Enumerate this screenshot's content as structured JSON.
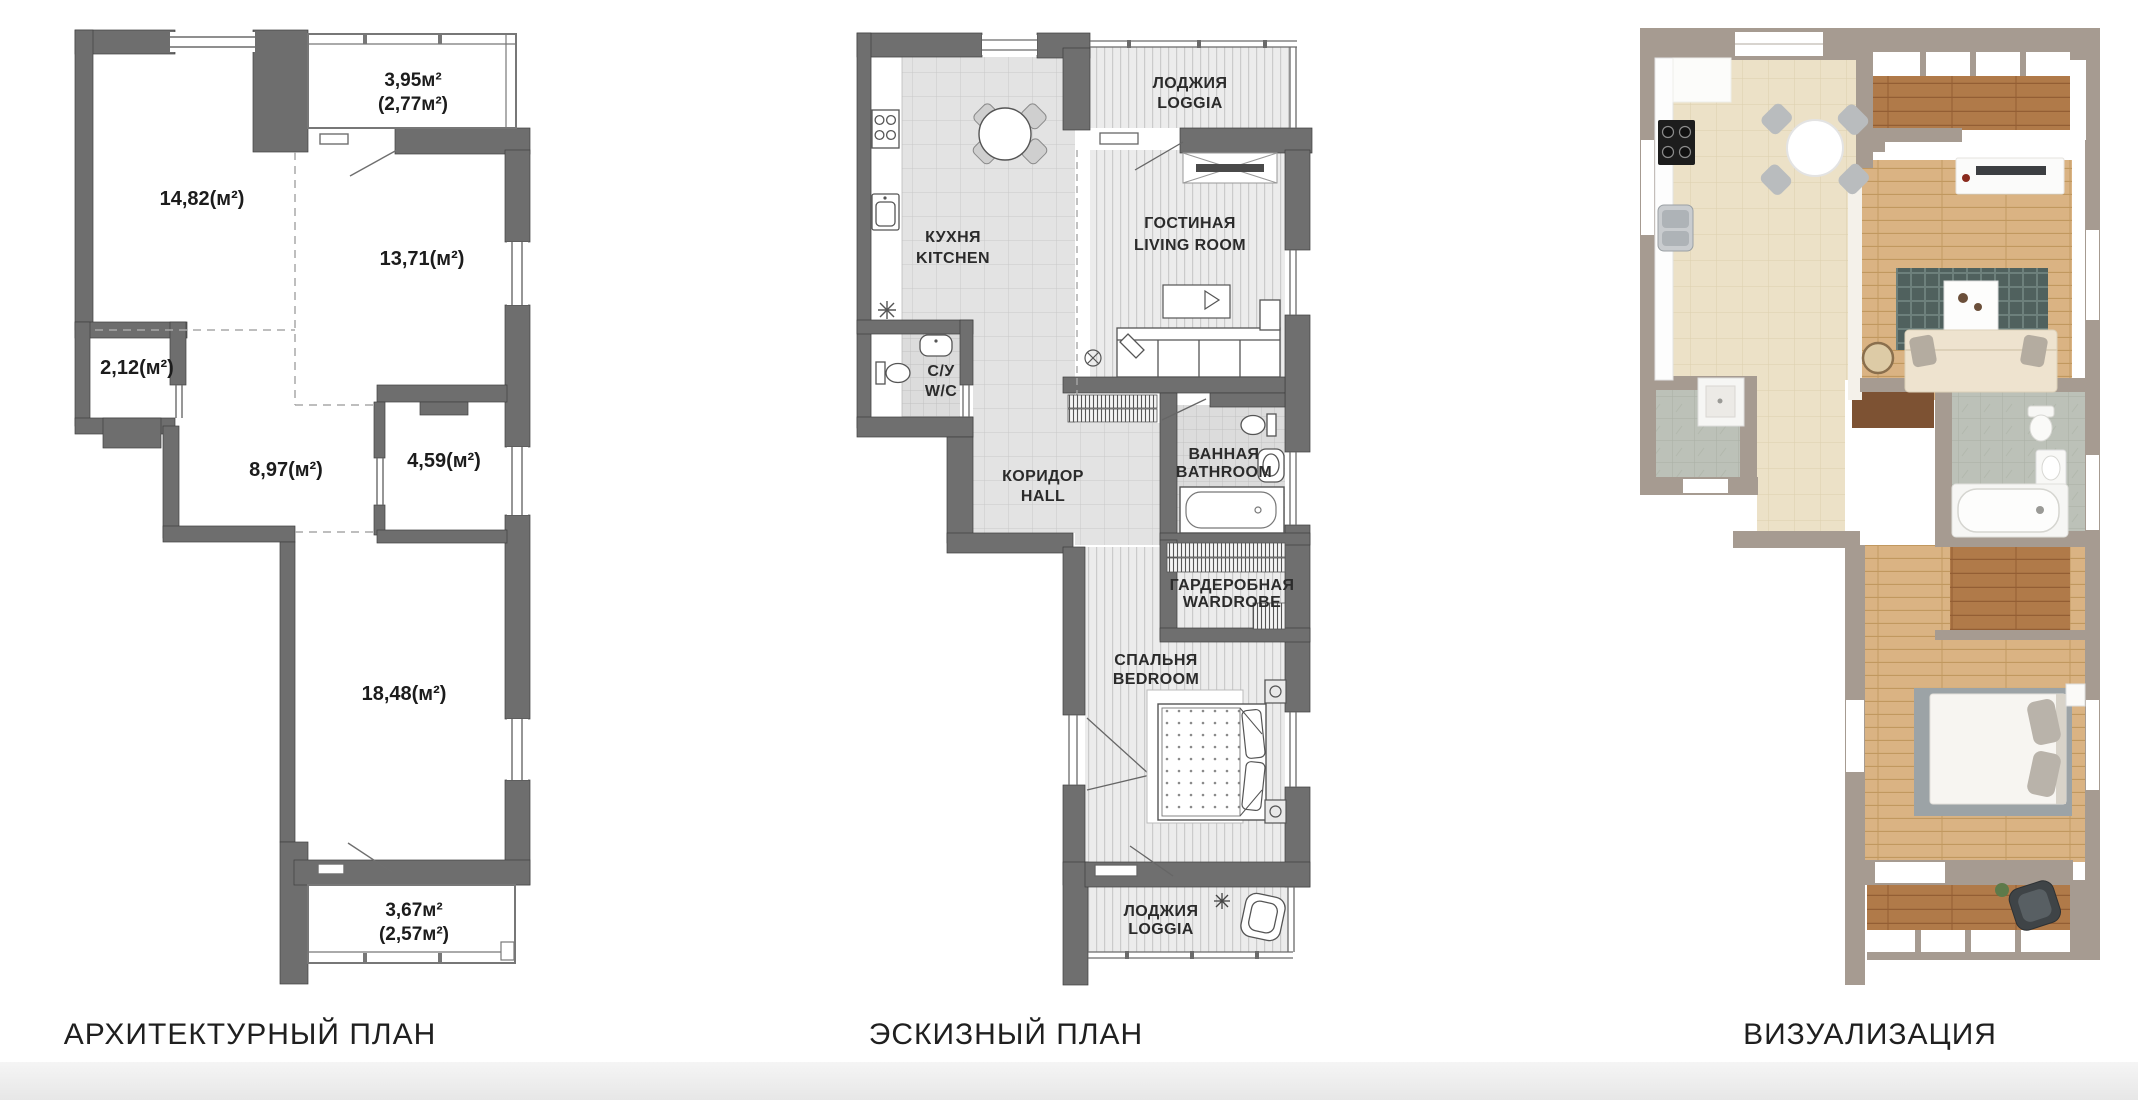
{
  "captions": {
    "architectural": "АРХИТЕКТУРНЫЙ ПЛАН",
    "sketch": "ЭСКИЗНЫЙ ПЛАН",
    "visualization": "ВИЗУАЛИЗАЦИЯ"
  },
  "architectural_plan": {
    "areas": {
      "loggia_top": "3,95м²",
      "loggia_top_alt": "(2,77м²)",
      "room_top_left": "14,82(м²)",
      "room_top_right": "13,71(м²)",
      "niche": "2,12(м²)",
      "hall": "8,97(м²)",
      "bathroom": "4,59(м²)",
      "room_bottom": "18,48(м²)",
      "loggia_bottom": "3,67м²",
      "loggia_bottom_alt": "(2,57м²)"
    }
  },
  "sketch_plan": {
    "rooms": {
      "kitchen": {
        "ru": "КУХНЯ",
        "en": "KITCHEN"
      },
      "loggia_top": {
        "ru": "ЛОДЖИЯ",
        "en": "LOGGIA"
      },
      "living": {
        "ru": "ГОСТИНАЯ",
        "en": "LIVING ROOM"
      },
      "wc": {
        "ru": "С/У",
        "en": "W/C"
      },
      "hall": {
        "ru": "КОРИДОР",
        "en": "HALL"
      },
      "bathroom": {
        "ru": "ВАННАЯ",
        "en": "BATHROOM"
      },
      "wardrobe": {
        "ru": "ГАРДЕРОБНАЯ",
        "en": "WARDROBE"
      },
      "bedroom": {
        "ru": "СПАЛЬНЯ",
        "en": "BEDROOM"
      },
      "loggia_bottom": {
        "ru": "ЛОДЖИЯ",
        "en": "LOGGIA"
      }
    }
  },
  "colors": {
    "plan_wall": "#6e6e6e",
    "viz_wall": "#a69b91",
    "tile_floor": "#e3e3e3",
    "beige_tile": "#ece1c7",
    "wood_light": "#dab383",
    "wood_dark": "#b07a49",
    "marble": "#bcc1b8",
    "rug_teal": "#50615e",
    "footer_band": "#ebebeb"
  }
}
